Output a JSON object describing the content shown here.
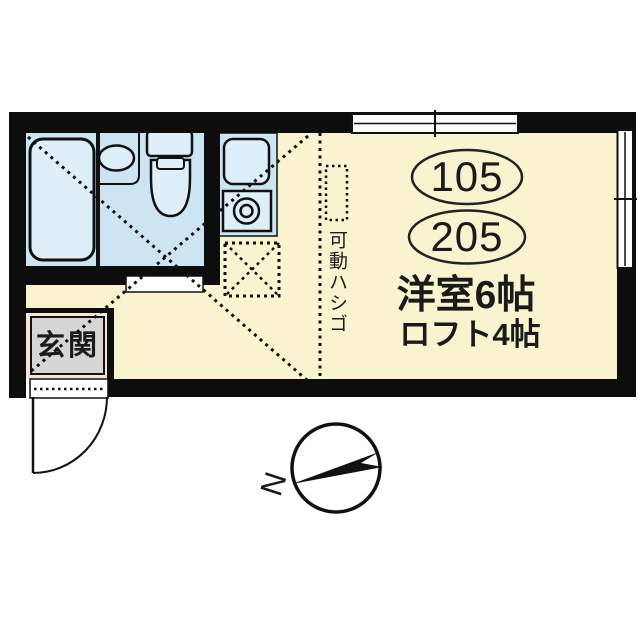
{
  "floorplan": {
    "unit_numbers": {
      "first": "105",
      "second": "205"
    },
    "room_label": "洋室6帖",
    "loft_label": "ロフト4帖",
    "entrance_label": "玄関",
    "ladder_label": "可動ハシゴ",
    "compass_north_label": "N",
    "colors": {
      "floor": "#F9F3CF",
      "wet_area": "#CDE4F2",
      "fixture": "#DFEFFA",
      "wall": "#0D0D0D",
      "entrance_hall": "#F6E3DA",
      "entrance_step": "#D6D6D6",
      "line": "#111111"
    }
  }
}
